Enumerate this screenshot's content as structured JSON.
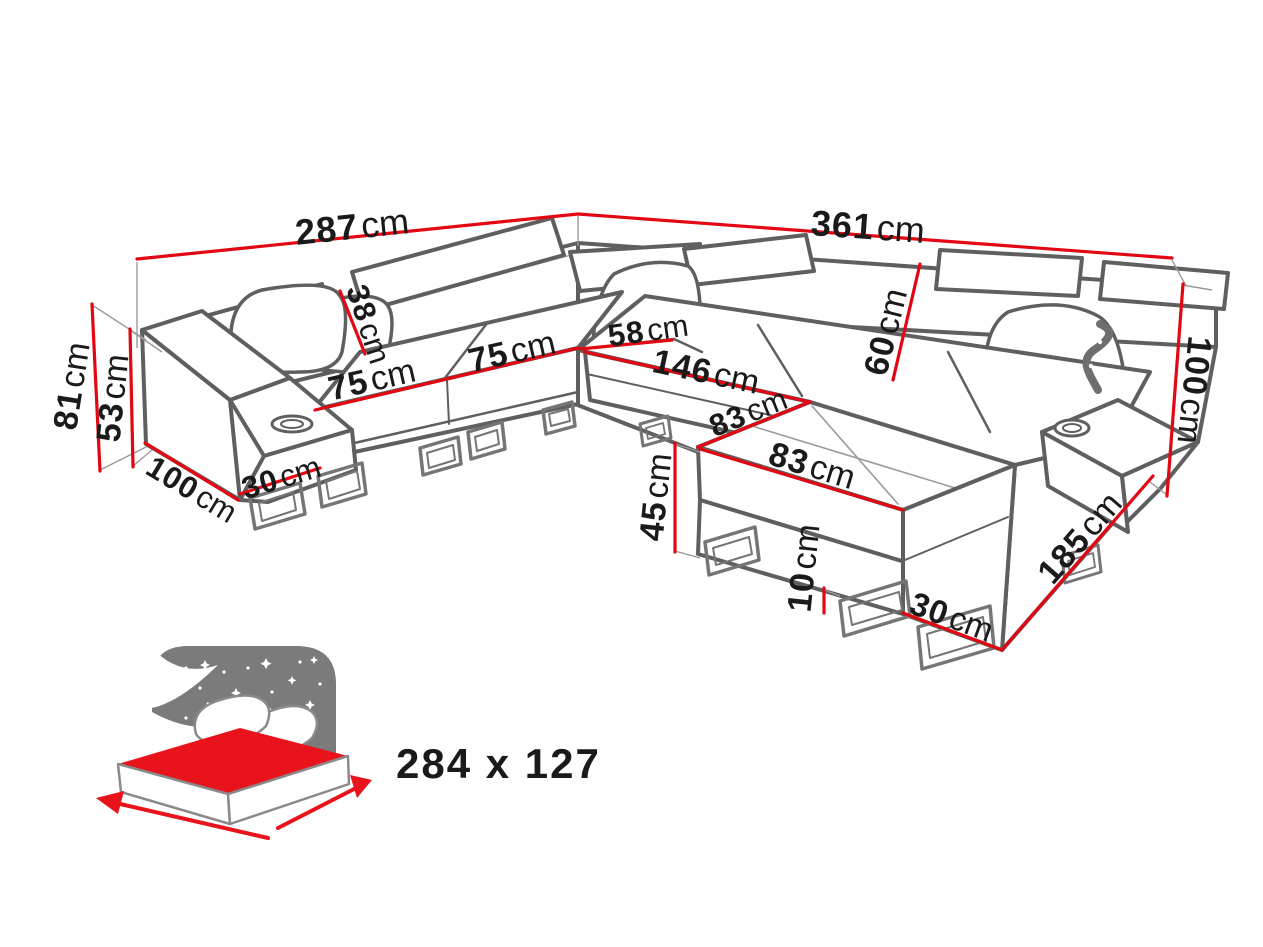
{
  "diagram": {
    "type": "corner-sofa-dimension-drawing",
    "unit": "cm",
    "dimensions": {
      "d287": {
        "value": "287",
        "unit": "cm"
      },
      "d361": {
        "value": "361",
        "unit": "cm"
      },
      "d81": {
        "value": "81",
        "unit": "cm"
      },
      "d53": {
        "value": "53",
        "unit": "cm"
      },
      "d100L": {
        "value": "100",
        "unit": "cm"
      },
      "d30L": {
        "value": "30",
        "unit": "cm"
      },
      "d38": {
        "value": "38",
        "unit": "cm"
      },
      "d75a": {
        "value": "75",
        "unit": "cm"
      },
      "d75b": {
        "value": "75",
        "unit": "cm"
      },
      "d58": {
        "value": "58",
        "unit": "cm"
      },
      "d146": {
        "value": "146",
        "unit": "cm"
      },
      "d60": {
        "value": "60",
        "unit": "cm"
      },
      "d83a": {
        "value": "83",
        "unit": "cm"
      },
      "d83b": {
        "value": "83",
        "unit": "cm"
      },
      "d45": {
        "value": "45",
        "unit": "cm"
      },
      "d10": {
        "value": "10",
        "unit": "cm"
      },
      "d30R": {
        "value": "30",
        "unit": "cm"
      },
      "d185": {
        "value": "185",
        "unit": "cm"
      },
      "d100R": {
        "value": "100",
        "unit": "cm"
      }
    },
    "sleeping_area": {
      "label": "284 x 127"
    },
    "colors": {
      "dimension_line": "#e30613",
      "label_text": "#1a1a1a",
      "sofa_line": "#5f5f5f",
      "icon_gray": "#7b7b7b",
      "icon_red": "#e8131b",
      "size_text": "#6e6e6e"
    }
  }
}
